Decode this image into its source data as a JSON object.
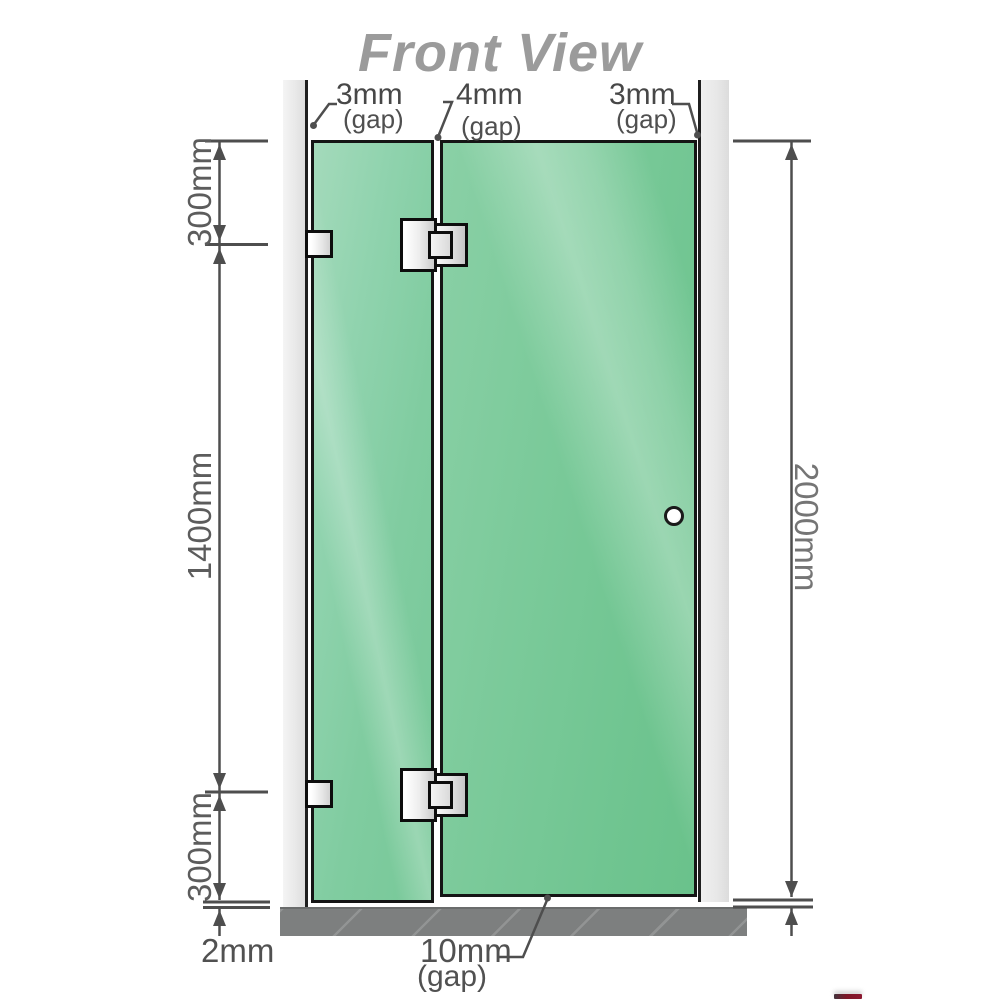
{
  "title": "Front View",
  "dimensions": {
    "top_gaps": [
      {
        "value": "3mm",
        "label": "(gap)"
      },
      {
        "value": "4mm",
        "label": "(gap)"
      },
      {
        "value": "3mm",
        "label": "(gap)"
      }
    ],
    "left": {
      "top": "300mm",
      "middle": "1400mm",
      "bottom": "300mm",
      "floor_gap": "2mm"
    },
    "right": {
      "total_height": "2000mm"
    },
    "bottom_gap": {
      "value": "10mm",
      "label": "(gap)"
    }
  },
  "colors": {
    "glass_green": "#7bca9a",
    "glass_highlight": "#a4dabb",
    "wall_channel_gray": "#e9e9e9",
    "floor_gray": "#7d7f7f",
    "outline_black": "#151515",
    "dimension_gray": "#4e4e4e",
    "title_gray": "#9b9b9b",
    "hinge_metal": "#ececec",
    "logo_red": "#8c1830"
  }
}
